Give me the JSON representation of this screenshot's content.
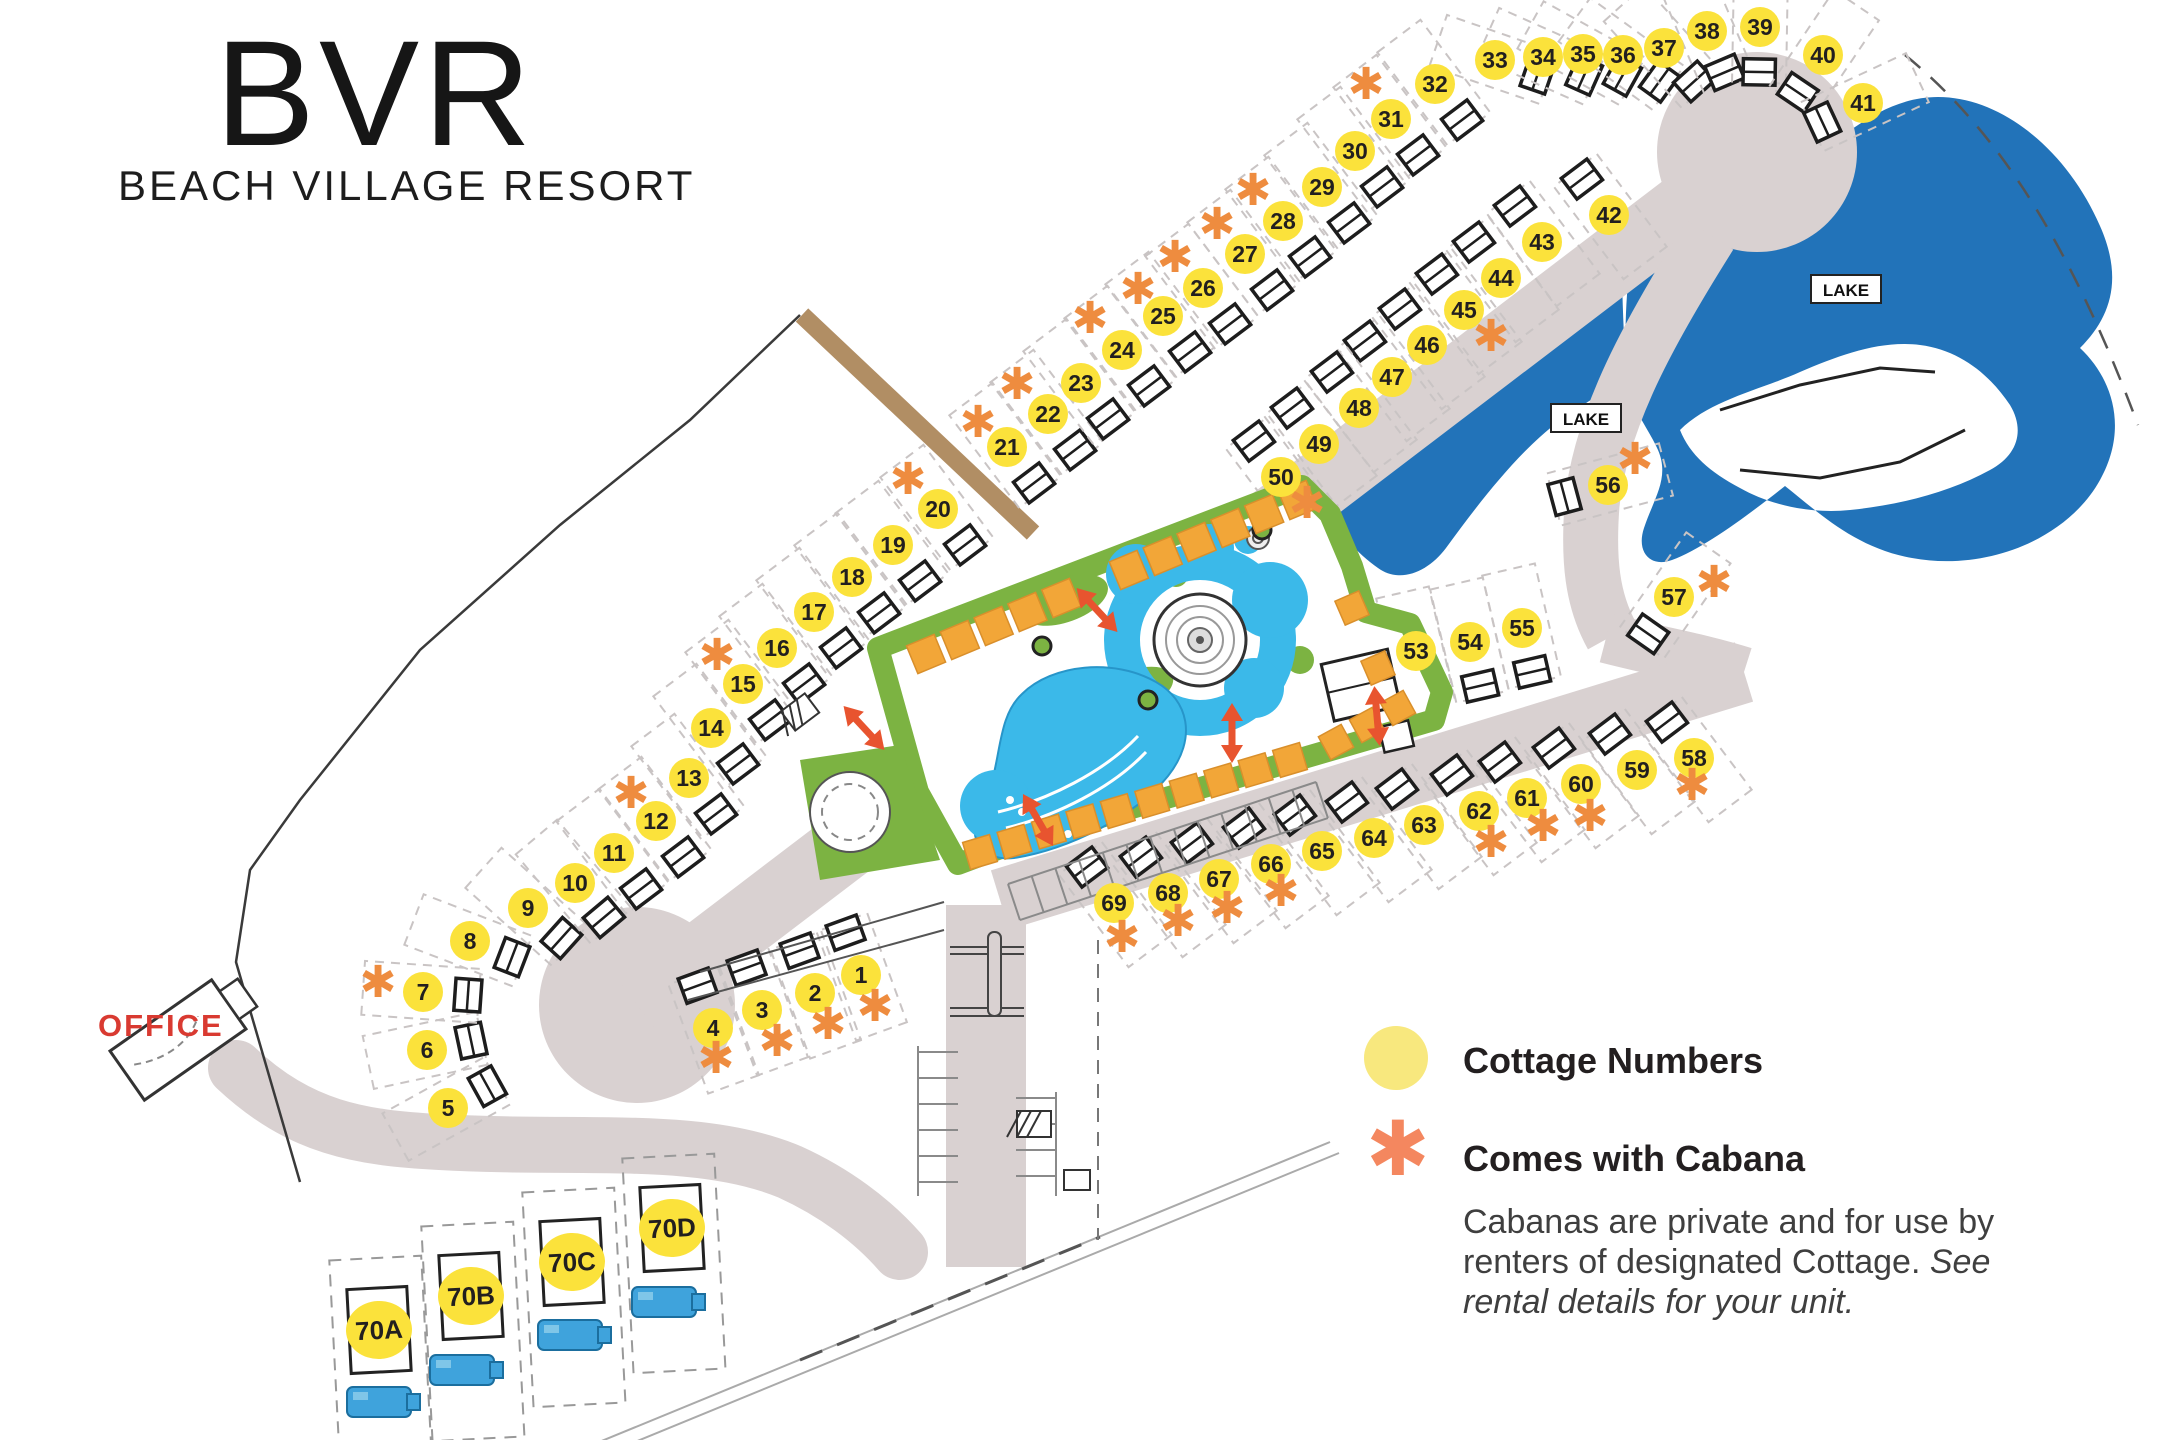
{
  "title": {
    "logo": "BVR",
    "subtitle": "BEACH VILLAGE RESORT"
  },
  "labels": {
    "office": "OFFICE"
  },
  "lake_labels": [
    {
      "text": "LAKE",
      "x": 1846,
      "y": 290
    },
    {
      "text": "LAKE",
      "x": 1586,
      "y": 419
    }
  ],
  "legend": {
    "item1": "Cottage Numbers",
    "item2": "Comes with Cabana",
    "body": "Cabanas are private and for use by renters of designated Cottage. ",
    "body_italic": "See rental details for your unit."
  },
  "colors": {
    "marker_yellow": "#FBE23B",
    "legend_yellow": "#F8E87E",
    "asterisk_orange": "#EE8C3F",
    "legend_asterisk": "#F4875F",
    "cabana_square": "#F2A638",
    "green": "#7CB342",
    "pool_blue": "#3BB9E9",
    "lake_blue": "#2273B9",
    "road_gray": "#D9D1D1",
    "office_red": "#D93A31"
  },
  "cottages": [
    {
      "n": "1",
      "x": 861,
      "y": 975,
      "rot": 160,
      "cab": true,
      "cx": 14,
      "cy": 32
    },
    {
      "n": "2",
      "x": 815,
      "y": 993,
      "rot": 160,
      "cab": true,
      "cx": 13,
      "cy": 32
    },
    {
      "n": "3",
      "x": 762,
      "y": 1010,
      "rot": 160,
      "cab": true,
      "cx": 15,
      "cy": 32
    },
    {
      "n": "4",
      "x": 713,
      "y": 1028,
      "rot": 160,
      "cab": true,
      "cx": 3,
      "cy": 31
    },
    {
      "n": "5",
      "x": 448,
      "y": 1108,
      "rot": -119,
      "cab": false
    },
    {
      "n": "6",
      "x": 427,
      "y": 1050,
      "rot": -102,
      "cab": false
    },
    {
      "n": "7",
      "x": 423,
      "y": 992,
      "rot": -86,
      "cab": true,
      "cx": -45,
      "cy": -9
    },
    {
      "n": "8",
      "x": 470,
      "y": 941,
      "rot": -69,
      "cab": false
    },
    {
      "n": "9",
      "x": 528,
      "y": 908,
      "rot": -48,
      "cab": false
    },
    {
      "n": "10",
      "x": 575,
      "y": 883,
      "rot": -40,
      "cab": false
    },
    {
      "n": "11",
      "x": 614,
      "y": 853,
      "rot": -37,
      "cab": false
    },
    {
      "n": "12",
      "x": 656,
      "y": 821,
      "rot": -37,
      "cab": true,
      "cx": -25,
      "cy": -27
    },
    {
      "n": "13",
      "x": 689,
      "y": 778,
      "rot": -37,
      "cab": false
    },
    {
      "n": "14",
      "x": 711,
      "y": 728,
      "rot": -37,
      "cab": false
    },
    {
      "n": "15",
      "x": 743,
      "y": 684,
      "rot": -37,
      "cab": true,
      "cx": -26,
      "cy": -28
    },
    {
      "n": "16",
      "x": 777,
      "y": 648,
      "rot": -37,
      "cab": false
    },
    {
      "n": "17",
      "x": 814,
      "y": 612,
      "rot": -37,
      "cab": false
    },
    {
      "n": "18",
      "x": 852,
      "y": 577,
      "rot": -37,
      "cab": false
    },
    {
      "n": "19",
      "x": 893,
      "y": 545,
      "rot": -37,
      "cab": false
    },
    {
      "n": "20",
      "x": 938,
      "y": 509,
      "rot": -37,
      "cab": true,
      "cx": -30,
      "cy": -29
    },
    {
      "n": "21",
      "x": 1007,
      "y": 447,
      "rot": -37,
      "cab": true,
      "cx": -29,
      "cy": -24
    },
    {
      "n": "22",
      "x": 1048,
      "y": 414,
      "rot": -37,
      "cab": true,
      "cx": -31,
      "cy": -29
    },
    {
      "n": "23",
      "x": 1081,
      "y": 383,
      "rot": -37,
      "cab": false
    },
    {
      "n": "24",
      "x": 1122,
      "y": 350,
      "rot": -37,
      "cab": true,
      "cx": -32,
      "cy": -31
    },
    {
      "n": "25",
      "x": 1163,
      "y": 316,
      "rot": -37,
      "cab": true,
      "cx": -25,
      "cy": -26
    },
    {
      "n": "26",
      "x": 1203,
      "y": 288,
      "rot": -37,
      "cab": true,
      "cx": -28,
      "cy": -30
    },
    {
      "n": "27",
      "x": 1245,
      "y": 254,
      "rot": -37,
      "cab": true,
      "cx": -28,
      "cy": -29
    },
    {
      "n": "28",
      "x": 1283,
      "y": 221,
      "rot": -37,
      "cab": true,
      "cx": -30,
      "cy": -30
    },
    {
      "n": "29",
      "x": 1322,
      "y": 187,
      "rot": -37,
      "cab": false
    },
    {
      "n": "30",
      "x": 1355,
      "y": 151,
      "rot": -37,
      "cab": false
    },
    {
      "n": "31",
      "x": 1391,
      "y": 119,
      "rot": -37,
      "cab": false
    },
    {
      "n": "32",
      "x": 1435,
      "y": 84,
      "rot": -37,
      "cab": true,
      "cx": -69,
      "cy": 1
    },
    {
      "n": "33",
      "x": 1495,
      "y": 60,
      "rot": -71,
      "cab": false
    },
    {
      "n": "34",
      "x": 1543,
      "y": 57,
      "rot": -66,
      "cab": false
    },
    {
      "n": "35",
      "x": 1583,
      "y": 54,
      "rot": -61,
      "cab": false
    },
    {
      "n": "36",
      "x": 1623,
      "y": 55,
      "rot": -54,
      "cab": false
    },
    {
      "n": "37",
      "x": 1664,
      "y": 48,
      "rot": -42,
      "cab": false
    },
    {
      "n": "38",
      "x": 1707,
      "y": 31,
      "rot": -23,
      "cab": false
    },
    {
      "n": "39",
      "x": 1760,
      "y": 27,
      "rot": 1,
      "cab": false
    },
    {
      "n": "40",
      "x": 1823,
      "y": 55,
      "rot": 34,
      "cab": false
    },
    {
      "n": "41",
      "x": 1863,
      "y": 103,
      "rot": 65,
      "cab": false
    },
    {
      "n": "42",
      "x": 1609,
      "y": 215,
      "rot": 143,
      "cab": false
    },
    {
      "n": "43",
      "x": 1542,
      "y": 242,
      "rot": 143,
      "cab": false
    },
    {
      "n": "44",
      "x": 1501,
      "y": 278,
      "rot": 143,
      "cab": false
    },
    {
      "n": "45",
      "x": 1464,
      "y": 310,
      "rot": 143,
      "cab": true,
      "cx": 27,
      "cy": 27
    },
    {
      "n": "46",
      "x": 1427,
      "y": 345,
      "rot": 143,
      "cab": false
    },
    {
      "n": "47",
      "x": 1392,
      "y": 377,
      "rot": 143,
      "cab": false
    },
    {
      "n": "48",
      "x": 1359,
      "y": 408,
      "rot": 143,
      "cab": false
    },
    {
      "n": "49",
      "x": 1319,
      "y": 444,
      "rot": 143,
      "cab": false
    },
    {
      "n": "50",
      "x": 1281,
      "y": 477,
      "rot": 143,
      "cab": true,
      "cx": 26,
      "cy": 27
    },
    {
      "n": "53",
      "x": 1416,
      "y": 651,
      "rot": -13,
      "cab": false
    },
    {
      "n": "54",
      "x": 1470,
      "y": 642,
      "rot": -13,
      "cab": false
    },
    {
      "n": "55",
      "x": 1522,
      "y": 628,
      "rot": -13,
      "cab": false
    },
    {
      "n": "56",
      "x": 1608,
      "y": 485,
      "rot": 75,
      "cab": true,
      "cx": 27,
      "cy": -25
    },
    {
      "n": "57",
      "x": 1674,
      "y": 597,
      "rot": 35,
      "cab": true,
      "cx": 40,
      "cy": -14
    },
    {
      "n": "58",
      "x": 1694,
      "y": 758,
      "rot": 143,
      "cab": true,
      "cx": -2,
      "cy": 28
    },
    {
      "n": "59",
      "x": 1637,
      "y": 770,
      "rot": 143,
      "cab": false
    },
    {
      "n": "60",
      "x": 1581,
      "y": 784,
      "rot": 143,
      "cab": true,
      "cx": 9,
      "cy": 33
    },
    {
      "n": "61",
      "x": 1527,
      "y": 798,
      "rot": 143,
      "cab": true,
      "cx": 16,
      "cy": 29
    },
    {
      "n": "62",
      "x": 1479,
      "y": 811,
      "rot": 143,
      "cab": true,
      "cx": 12,
      "cy": 32
    },
    {
      "n": "63",
      "x": 1424,
      "y": 825,
      "rot": 143,
      "cab": false
    },
    {
      "n": "64",
      "x": 1374,
      "y": 838,
      "rot": 143,
      "cab": false
    },
    {
      "n": "65",
      "x": 1322,
      "y": 851,
      "rot": 143,
      "cab": false
    },
    {
      "n": "66",
      "x": 1271,
      "y": 864,
      "rot": 143,
      "cab": true,
      "cx": 10,
      "cy": 28
    },
    {
      "n": "67",
      "x": 1219,
      "y": 879,
      "rot": 143,
      "cab": true,
      "cx": 8,
      "cy": 30
    },
    {
      "n": "68",
      "x": 1168,
      "y": 893,
      "rot": 143,
      "cab": true,
      "cx": 10,
      "cy": 29
    },
    {
      "n": "69",
      "x": 1114,
      "y": 903,
      "rot": 143,
      "cab": true,
      "cx": 8,
      "cy": 35
    }
  ],
  "units": [
    {
      "n": "70A",
      "x": 379,
      "y": 1330,
      "camx": 379,
      "camy": 1402
    },
    {
      "n": "70B",
      "x": 471,
      "y": 1296,
      "camx": 462,
      "camy": 1370
    },
    {
      "n": "70C",
      "x": 572,
      "y": 1262,
      "camx": 570,
      "camy": 1335
    },
    {
      "n": "70D",
      "x": 672,
      "y": 1228,
      "camx": 664,
      "camy": 1302
    }
  ]
}
